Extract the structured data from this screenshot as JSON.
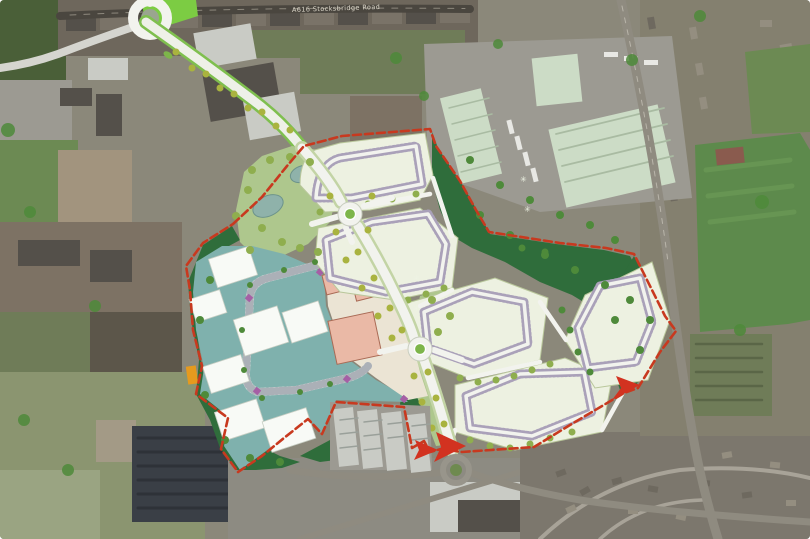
{
  "image": {
    "description": "Aerial photograph with masterplan overlay of mixed-use development site",
    "road_label": "A616 Stocksbridge Road",
    "sparkle_tree_glyph": "✳"
  },
  "colors": {
    "boundary_red": "#c8391f",
    "arrow_red": "#d23220",
    "employment_teal": "#7fb1ad",
    "unit_white": "#f8faf6",
    "unit_pink": "#eab9a6",
    "unit_pink_outline": "#a96a55",
    "parcel_cream": "#edf1e1",
    "parcel_outline": "#b9c79b",
    "plot_dash": "#aaa1b9",
    "green_dark": "#2f6d3b",
    "green_light": "#aec78d",
    "green_field_bright": "#7ccc43",
    "road_white": "#f2f3ee",
    "roundabout_green": "#7db54a",
    "pond_blue": "#8fb2aa",
    "tree_olive": "#8fae4e",
    "tree_dark": "#4e8a3a",
    "orange_marker": "#e59a1e",
    "purple_marker": "#a55fa5",
    "aerial_base": "#8b887a",
    "aerial_dark_roof": "#54504a",
    "aerial_light_roof": "#c9cbc5",
    "aerial_green_roof": "#ccdcc6",
    "aerial_field_green": "#6c8a53",
    "aerial_field_dark": "#4a5f38",
    "aerial_solar_dark": "#3a3f46",
    "aerial_housing": "#7c776d"
  }
}
